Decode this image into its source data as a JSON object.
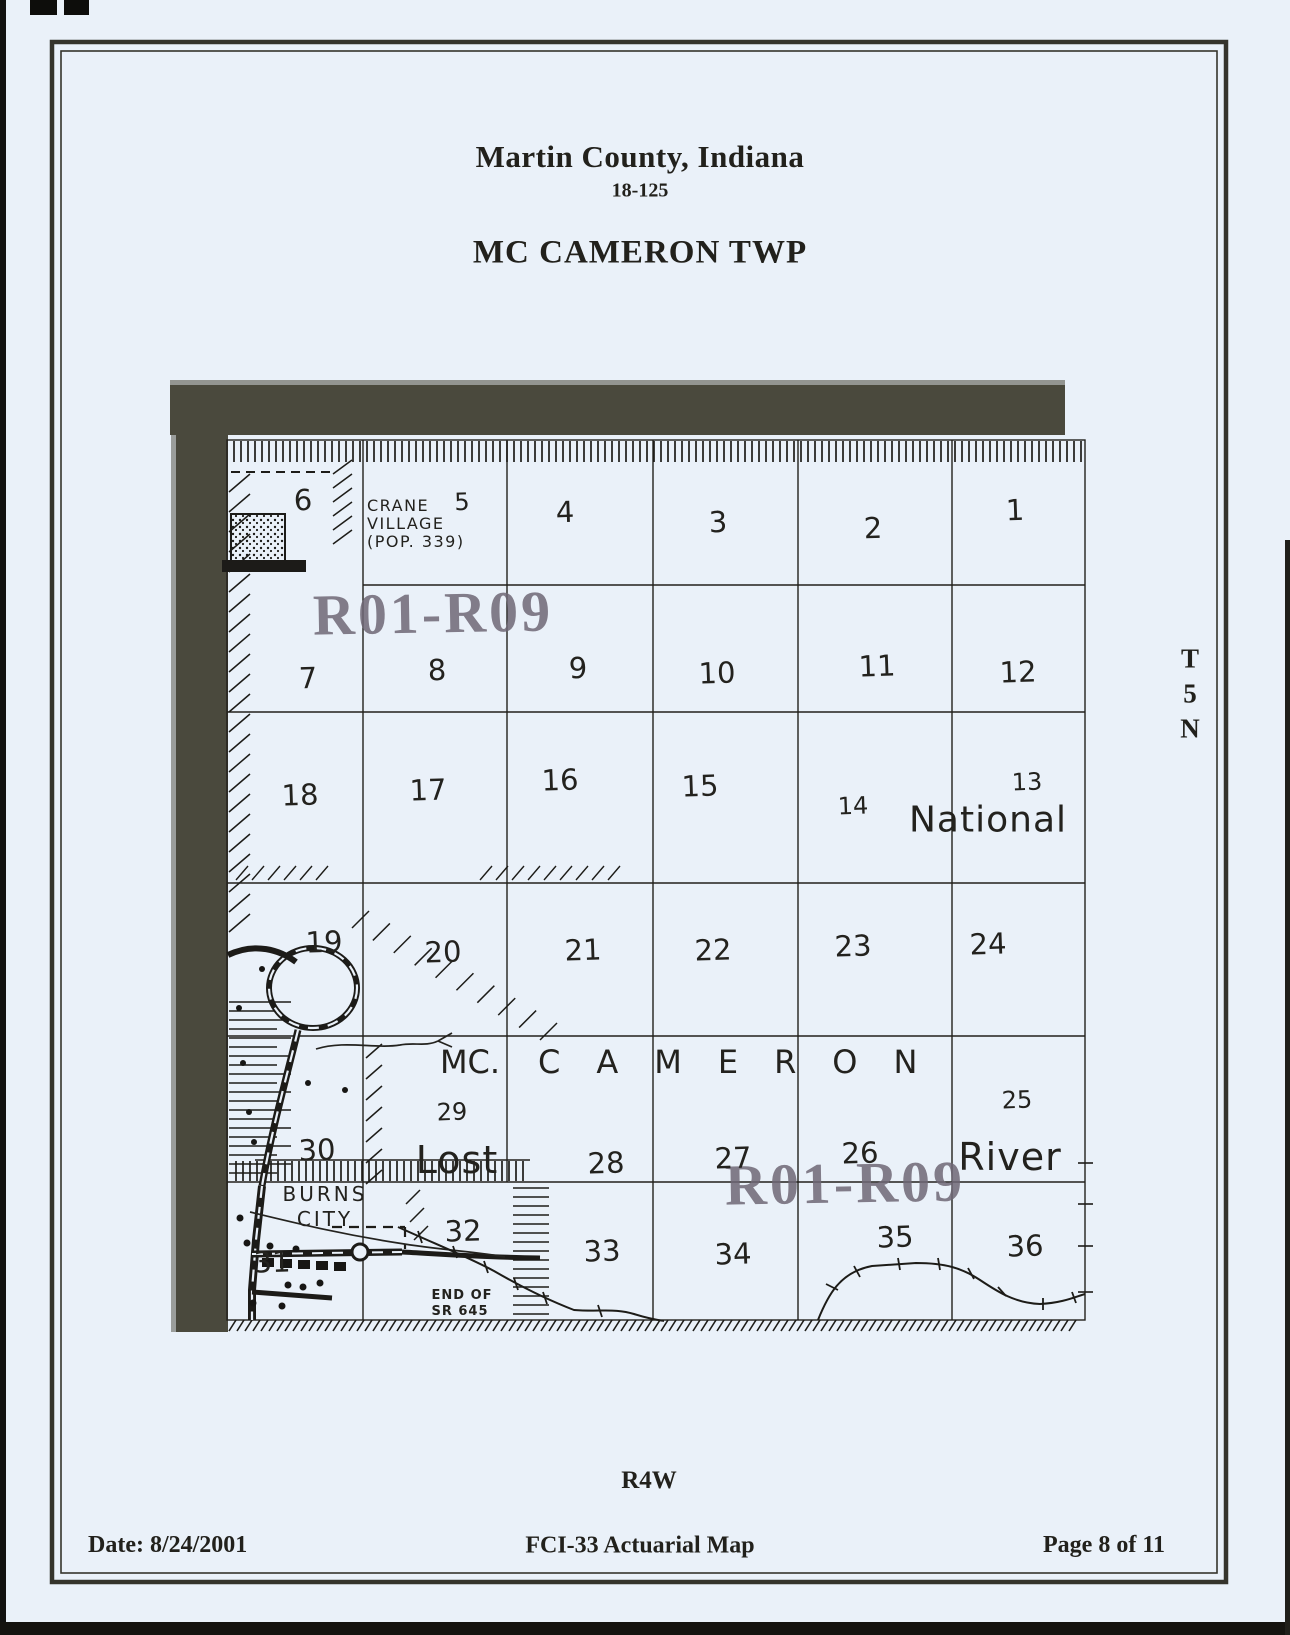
{
  "header": {
    "county": "Martin County, Indiana",
    "code": "18-125",
    "township": "MC CAMERON TWP"
  },
  "margins": {
    "township_grid": {
      "t": "T",
      "five": "5",
      "n": "N"
    },
    "range": "R4W"
  },
  "footer": {
    "date": "Date: 8/24/2001",
    "title": "FCI-33 Actuarial Map",
    "page": "Page 8 of 11"
  },
  "map": {
    "stamp": "R01-R09",
    "labels": {
      "crane1": "CRANE",
      "crane2": "VILLAGE",
      "crane3": "(POP. 339)",
      "national": "National",
      "mc": "MC.",
      "cameron": "CAMERON",
      "lost": "Lost",
      "river": "River",
      "burns1": "BURNS",
      "burns2": "CITY",
      "end1": "END OF",
      "end2": "SR 645"
    },
    "sections": {
      "s1": "1",
      "s2": "2",
      "s3": "3",
      "s4": "4",
      "s5": "5",
      "s6": "6",
      "s7": "7",
      "s8": "8",
      "s9": "9",
      "s10": "10",
      "s11": "11",
      "s12": "12",
      "s13": "13",
      "s14": "14",
      "s15": "15",
      "s16": "16",
      "s17": "17",
      "s18": "18",
      "s19": "19",
      "s20": "20",
      "s21": "21",
      "s22": "22",
      "s23": "23",
      "s24": "24",
      "s25": "25",
      "s26": "26",
      "s27": "27",
      "s28": "28",
      "s29": "29",
      "s30": "30",
      "s31": "31",
      "s32": "32",
      "s33": "33",
      "s34": "34",
      "s35": "35",
      "s36": "36"
    },
    "colors": {
      "paper": "#eaf1f9",
      "ink": "#1d1c19",
      "scan_band": "#4a493d",
      "stamp": "#6f6876"
    }
  }
}
